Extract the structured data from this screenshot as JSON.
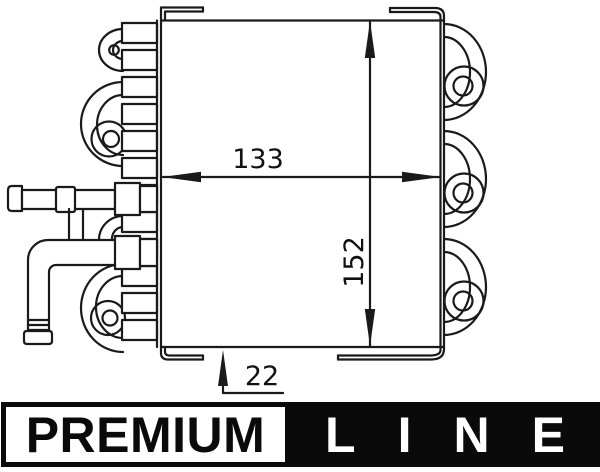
{
  "drawing": {
    "description": "technical line drawing of serpentine-tube heat exchanger, side view",
    "dimensions": {
      "width": "133",
      "height": "152",
      "offset": "22"
    }
  },
  "branding": {
    "premium": "PREMIUM",
    "line": "LINE"
  },
  "colors": {
    "line_art": "#1a1a1a",
    "banner_black": "#0a0a0a",
    "background": "#ffffff",
    "text": "#111111"
  }
}
